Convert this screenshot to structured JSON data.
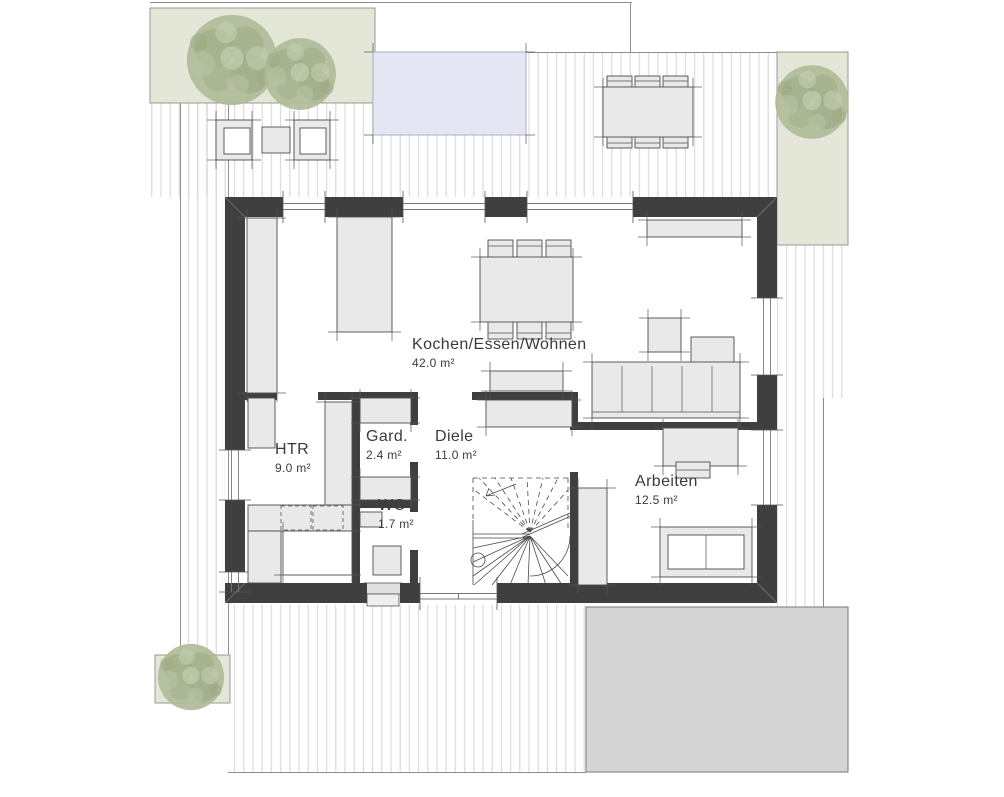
{
  "plan": {
    "floor_type": "floorplan",
    "rooms": [
      {
        "name": "Kochen/Essen/Wohnen",
        "area": "42.0 m²"
      },
      {
        "name": "Diele",
        "area": "11.0 m²"
      },
      {
        "name": "Gard.",
        "area": "2.4 m²"
      },
      {
        "name": "WC",
        "area": "1.7 m²"
      },
      {
        "name": "HTR",
        "area": "9.0 m²"
      },
      {
        "name": "Arbeiten",
        "area": "12.5 m²"
      }
    ]
  },
  "colors": {
    "wall": "#3f3f3f",
    "furniture_fill": "#e9e9e9",
    "deck_line": "#d3d3d3",
    "bed_fill": "#e4e6d8",
    "pool_fill": "#e4e6f4",
    "driveway_fill": "#d5d5d5"
  }
}
